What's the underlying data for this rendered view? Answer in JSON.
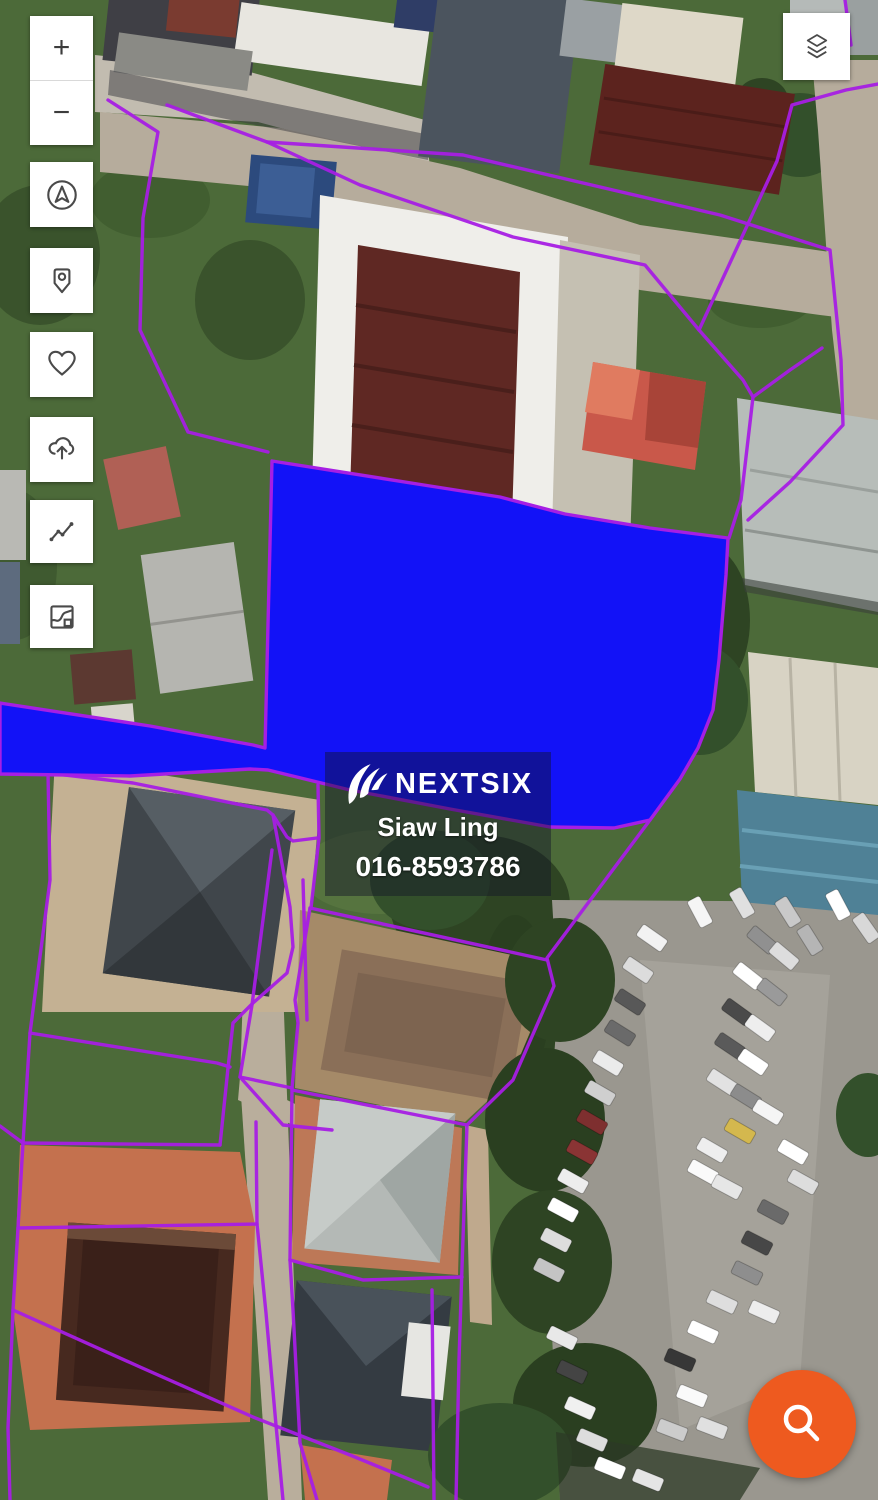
{
  "map": {
    "label": {
      "brand": "NEXTSIX",
      "agent_name": "Siaw Ling",
      "agent_phone": "016-8593786"
    }
  },
  "controls": {
    "zoom_in": "+",
    "zoom_out": "−",
    "icons": [
      "compass-locate-icon",
      "map-pin-icon",
      "heart-icon",
      "cloud-upload-icon",
      "line-chart-icon",
      "map-snippet-icon",
      "layers-icon",
      "search-icon"
    ]
  },
  "colors": {
    "parcel_line": "#A61EE4",
    "highlighted_parcel": "#1212F7",
    "search_fab": "#EE5A1F",
    "button_background": "#FFFFFF",
    "button_icon": "#4A4A4A"
  }
}
